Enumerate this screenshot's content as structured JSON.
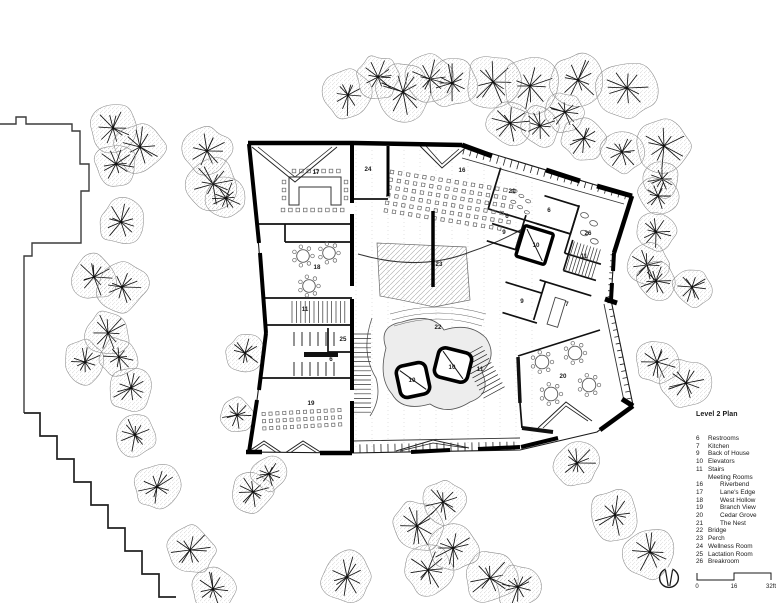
{
  "legend": {
    "title": "Level 2 Plan",
    "items": [
      {
        "num": "6",
        "label": "Restrooms",
        "indent": false
      },
      {
        "num": "7",
        "label": "Kitchen",
        "indent": false
      },
      {
        "num": "9",
        "label": "Back of House",
        "indent": false
      },
      {
        "num": "10",
        "label": "Elevators",
        "indent": false
      },
      {
        "num": "11",
        "label": "Stairs",
        "indent": false
      },
      {
        "num": "",
        "label": "Meeting Rooms",
        "indent": false
      },
      {
        "num": "16",
        "label": "Riverbend",
        "indent": true
      },
      {
        "num": "17",
        "label": "Lane's Edge",
        "indent": true
      },
      {
        "num": "18",
        "label": "West Hollow",
        "indent": true
      },
      {
        "num": "19",
        "label": "Branch View",
        "indent": true
      },
      {
        "num": "20",
        "label": "Cedar Grove",
        "indent": true
      },
      {
        "num": "21",
        "label": "The Nest",
        "indent": true
      },
      {
        "num": "22",
        "label": "Bridge",
        "indent": false
      },
      {
        "num": "23",
        "label": "Perch",
        "indent": false
      },
      {
        "num": "24",
        "label": "Wellness Room",
        "indent": false
      },
      {
        "num": "25",
        "label": "Lactation Room",
        "indent": false
      },
      {
        "num": "26",
        "label": "Breakroom",
        "indent": false
      }
    ]
  },
  "scale_bar": {
    "labels": [
      "0",
      "16",
      "32ft"
    ]
  },
  "plan": {
    "room_labels": [
      {
        "n": "17",
        "x": 316,
        "y": 174
      },
      {
        "n": "24",
        "x": 368,
        "y": 171
      },
      {
        "n": "16",
        "x": 462,
        "y": 172
      },
      {
        "n": "21",
        "x": 512,
        "y": 193
      },
      {
        "n": "6",
        "x": 507,
        "y": 218
      },
      {
        "n": "6",
        "x": 549,
        "y": 212
      },
      {
        "n": "9",
        "x": 504,
        "y": 234
      },
      {
        "n": "26",
        "x": 588,
        "y": 235
      },
      {
        "n": "10",
        "x": 536,
        "y": 247
      },
      {
        "n": "11",
        "x": 584,
        "y": 258
      },
      {
        "n": "18",
        "x": 317,
        "y": 269
      },
      {
        "n": "23",
        "x": 439,
        "y": 266
      },
      {
        "n": "9",
        "x": 522,
        "y": 303
      },
      {
        "n": "7",
        "x": 567,
        "y": 306
      },
      {
        "n": "22",
        "x": 438,
        "y": 329
      },
      {
        "n": "25",
        "x": 343,
        "y": 341
      },
      {
        "n": "11",
        "x": 305,
        "y": 311
      },
      {
        "n": "6",
        "x": 331,
        "y": 361
      },
      {
        "n": "10",
        "x": 412,
        "y": 382
      },
      {
        "n": "10",
        "x": 452,
        "y": 369
      },
      {
        "n": "11",
        "x": 480,
        "y": 371
      },
      {
        "n": "19",
        "x": 311,
        "y": 405
      },
      {
        "n": "20",
        "x": 563,
        "y": 378
      }
    ]
  },
  "colors": {
    "ink": "#1a1a1a",
    "wall": "#000000",
    "tree_outline": "#8a8a8a",
    "stipple": "#8c8c8c",
    "neighbor_line": "#3c3c3c",
    "shade": "#ededed"
  }
}
